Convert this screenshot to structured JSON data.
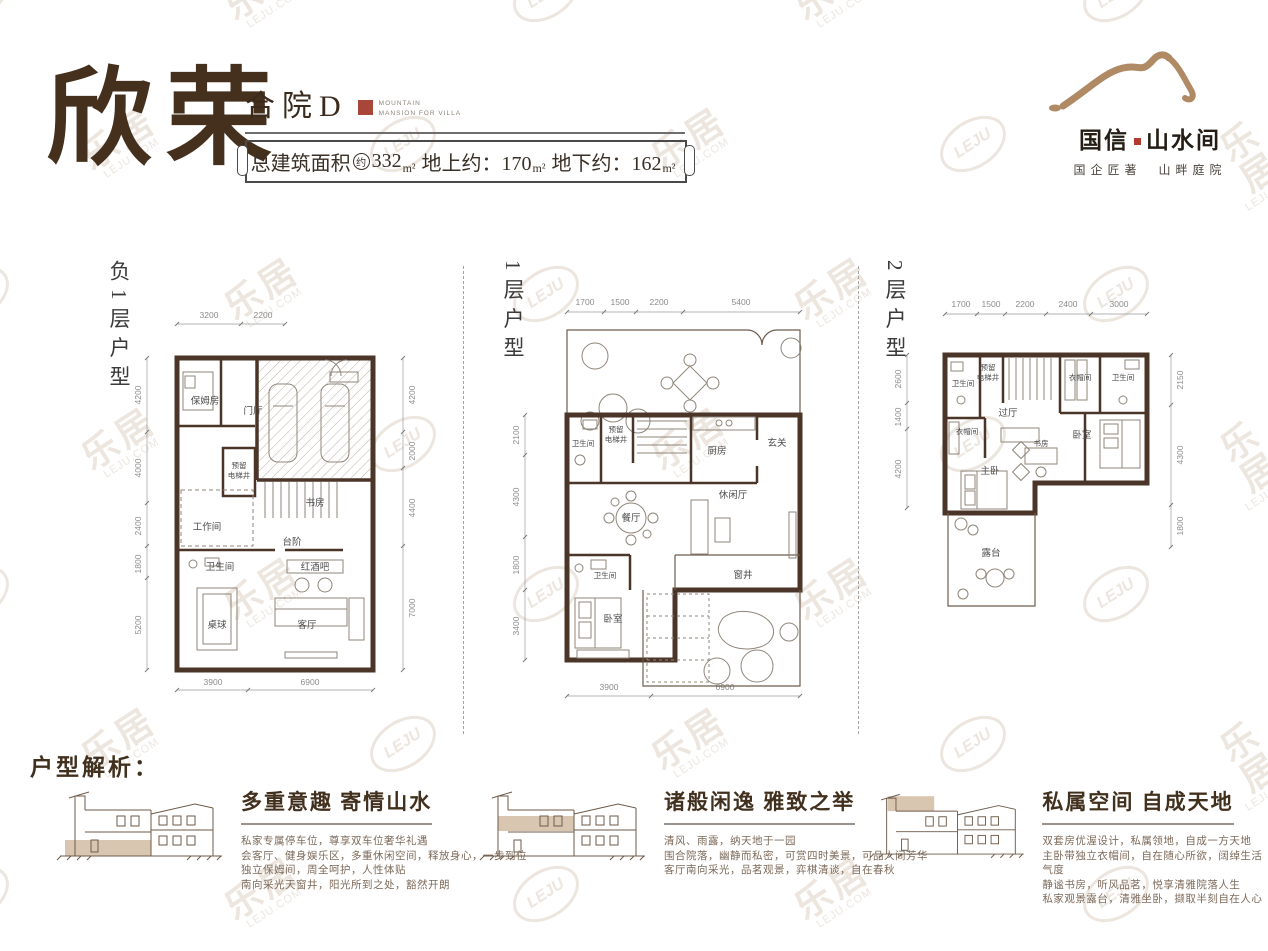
{
  "header": {
    "calligraphy_title": "欣荣",
    "unit_type": "合院D",
    "seal_caption_line1": "MOUNTAIN",
    "seal_caption_line2": "MANSION FOR VILLA",
    "banner": {
      "label": "总建筑面积",
      "approx_mark": "约",
      "total_value": "332",
      "total_unit": "m²",
      "above_ground": "地上约：170",
      "above_unit": "m²",
      "below_ground": "地下约：162",
      "below_unit": "m²"
    }
  },
  "logo": {
    "brand_first": "国信",
    "brand_second": "山水间",
    "tagline": "国企匠著　山畔庭院"
  },
  "colors": {
    "ink": "#45301d",
    "wall": "#4b3529",
    "mountain_tan": "#b08a65",
    "seal_red": "#a8463a",
    "highlight_tan": "#d9c6b1",
    "watermark": "#ece6df"
  },
  "watermark": {
    "cn": "乐居",
    "en": "LEJU.COM",
    "badge": "LEJU"
  },
  "plans": [
    {
      "label": "负1层户型",
      "dims_top": [
        "3200",
        "2200"
      ],
      "dims_left": [
        "4200",
        "4000",
        "2400",
        "1800",
        "5200"
      ],
      "dims_right": [
        "4200",
        "2000",
        "4400",
        "7000"
      ],
      "dims_bottom": [
        "3900",
        "6900"
      ],
      "rooms": {
        "nanny": "保姆房",
        "foyer": "门厅",
        "elevator_l1": "预留",
        "elevator_l2": "电梯井",
        "workroom": "工作间",
        "study": "书房",
        "steps": "台阶",
        "bath": "卫生间",
        "winebar": "红酒吧",
        "billiards": "桌球",
        "living": "客厅"
      }
    },
    {
      "label": "1层户型",
      "dims_top": [
        "1700",
        "1500",
        "2200",
        "5400"
      ],
      "dims_left": [
        "2100",
        "4300",
        "1800",
        "3400"
      ],
      "dims_bottom": [
        "3900",
        "6900"
      ],
      "rooms": {
        "bath1": "卫生间",
        "elevator_l1": "预留",
        "elevator_l2": "电梯井",
        "kitchen": "厨房",
        "entry": "玄关",
        "dining": "餐厅",
        "leisure": "休闲厅",
        "bath2": "卫生间",
        "bedroom": "卧室",
        "window_well": "窗井"
      }
    },
    {
      "label": "2层户型",
      "dims_top": [
        "1700",
        "1500",
        "2200",
        "2400",
        "3000"
      ],
      "dims_left": [
        "2600",
        "1400",
        "4200"
      ],
      "dims_right": [
        "2150",
        "4300",
        "1800"
      ],
      "rooms": {
        "bath1": "卫生间",
        "elevator_l1": "预留",
        "elevator_l2": "电梯井",
        "closet1": "衣帽间",
        "bath2": "卫生间",
        "hall": "过厅",
        "closet2": "衣帽间",
        "bedroom": "卧室",
        "study": "书房",
        "master": "主卧",
        "terrace": "露台"
      }
    }
  ],
  "analysis": {
    "heading": "户型解析：",
    "blocks": [
      {
        "title": "多重意趣 寄情山水",
        "lines": [
          "私家专属停车位，尊享双车位奢华礼遇",
          "会客厅、健身娱乐区，多重休闲空间，释放身心，一步到位",
          "独立保姆间，周全呵护，人性体贴",
          "南向采光天窗井，阳光所到之处，豁然开朗"
        ]
      },
      {
        "title": "诸般闲逸 雅致之举",
        "lines": [
          "清风、雨露，纳天地于一园",
          "围合院落，幽静而私密，可赏四时美景，可品人间芳华",
          "客厅南向采光，品茗观景，弈棋清谈，自在春秋"
        ]
      },
      {
        "title": "私属空间 自成天地",
        "lines": [
          "双套房优渥设计，私属领地，自成一方天地",
          "主卧带独立衣帽间，自在随心所欲，阔绰生活气度",
          "静谧书房，听风品茗，悦享清雅院落人生",
          "私家观景露台，清雅坐卧，撷取半刻自在人心"
        ]
      }
    ]
  }
}
